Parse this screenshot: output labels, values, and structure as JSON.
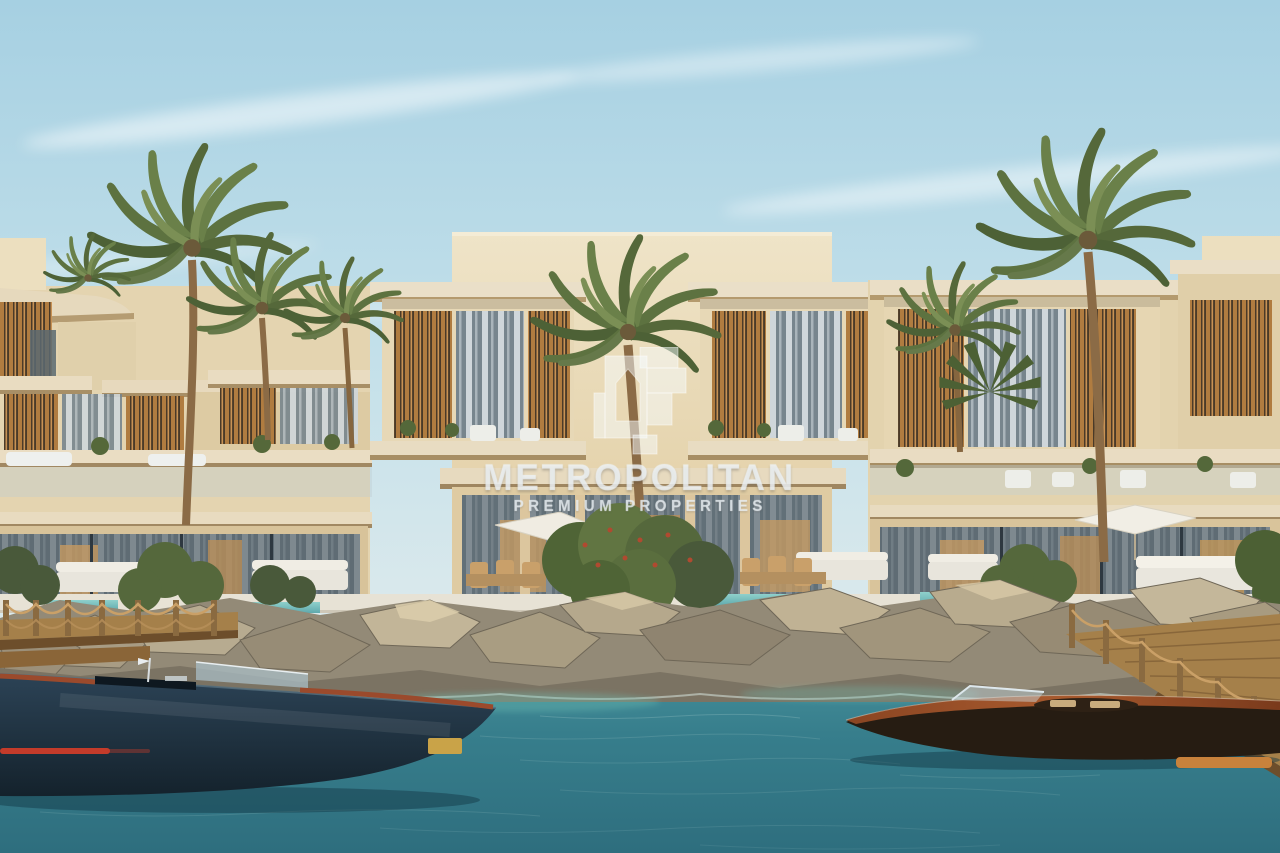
{
  "image": {
    "kind": "architectural-rendering-photo",
    "subject": "Waterfront beige villas with palm trees, rock breakwater, rope docks and two motorboats"
  },
  "watermark": {
    "logo_icon": "metropolitan-building-mark-icon",
    "title": "METROPOLITAN",
    "subtitle": "PREMIUM PROPERTIES"
  },
  "palette": {
    "sky_top": "#a6d0e2",
    "sky_horizon": "#ddeaec",
    "wall_light": "#eee3c8",
    "wall_warm": "#e0cb9f",
    "louver_wood": "#b07c40",
    "glass": "#57646c",
    "palm_green": "#5d7240",
    "rock_light": "#c2b598",
    "rock_dark": "#8f8470",
    "water_top": "#4b96a0",
    "water_deep": "#2e6e7e",
    "shallow_turquoise": "#6fc0b4",
    "dock_wood": "#a5804a",
    "navy_hull": "#22384a",
    "red_stripe": "#c33b2a",
    "mahogany_deck": "#a85a2e"
  }
}
